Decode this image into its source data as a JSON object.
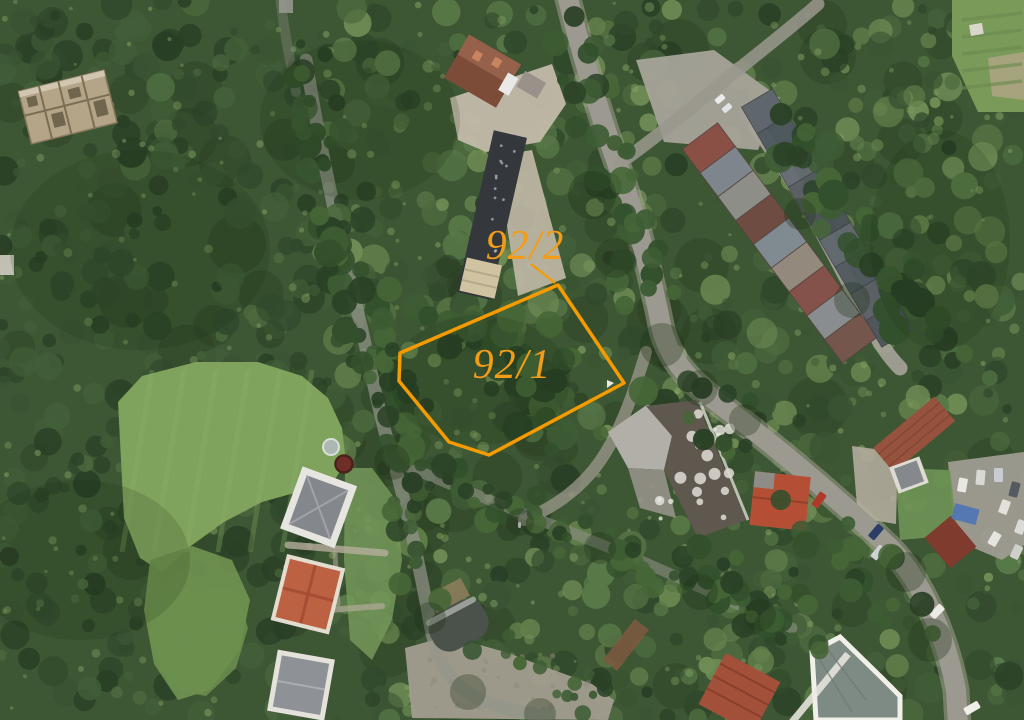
{
  "map": {
    "view_type": "aerial-cadastral-imagery",
    "overlay": {
      "accent_color": "#f59b00",
      "label_color": "#f29c17",
      "label_font_size": 42,
      "parcels": [
        {
          "id": "92/1",
          "label": "92/1",
          "label_x": 512,
          "label_y": 378,
          "polygon": "558,285 400,353 399,381 449,442 489,455 624,383",
          "stroke_width": 3.5
        },
        {
          "id": "92/2",
          "label": "92/2",
          "label_x": 525,
          "label_y": 259,
          "leader": "531,264 555,283",
          "leader_width": 2.2
        }
      ]
    }
  }
}
